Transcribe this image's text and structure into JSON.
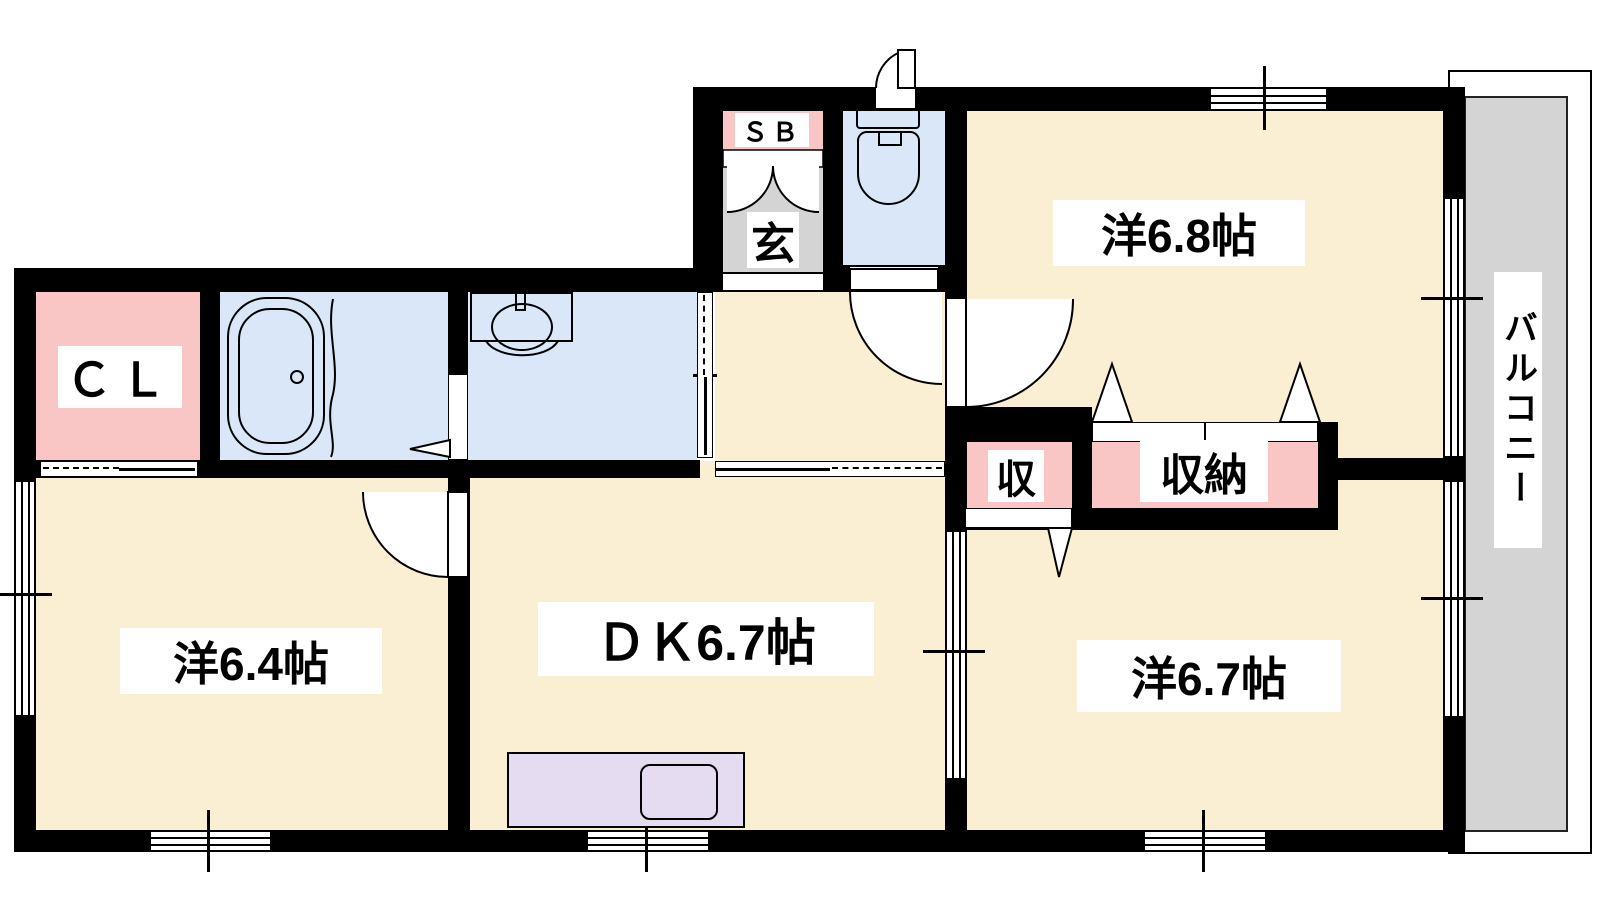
{
  "labels": {
    "room_top_right": "洋6.8帖",
    "room_bottom_left": "洋6.4帖",
    "dining_kitchen": "ＤＫ6.7帖",
    "room_bottom_right": "洋6.7帖",
    "closet_cl": "ＣＬ",
    "shoe_box": "ＳＢ",
    "entrance": "玄",
    "storage_small": "収",
    "storage": "収納",
    "balcony": "バルコニー"
  },
  "colors": {
    "floor_cream": "#faeed3",
    "wet_area_blue": "#d9e7f8",
    "closet_pink": "#f9c5c5",
    "entrance_gray": "#d4d4d4",
    "balcony_gray": "#d4d4d4",
    "kitchen_counter_lavender": "#e6dcf2",
    "wall_black": "#000000",
    "label_background": "#ffffff"
  },
  "icons": {
    "bathtub": "bathtub-icon",
    "washbasin": "washbasin-icon",
    "toilet": "toilet-icon",
    "kitchen_sink": "kitchen-sink-icon"
  }
}
